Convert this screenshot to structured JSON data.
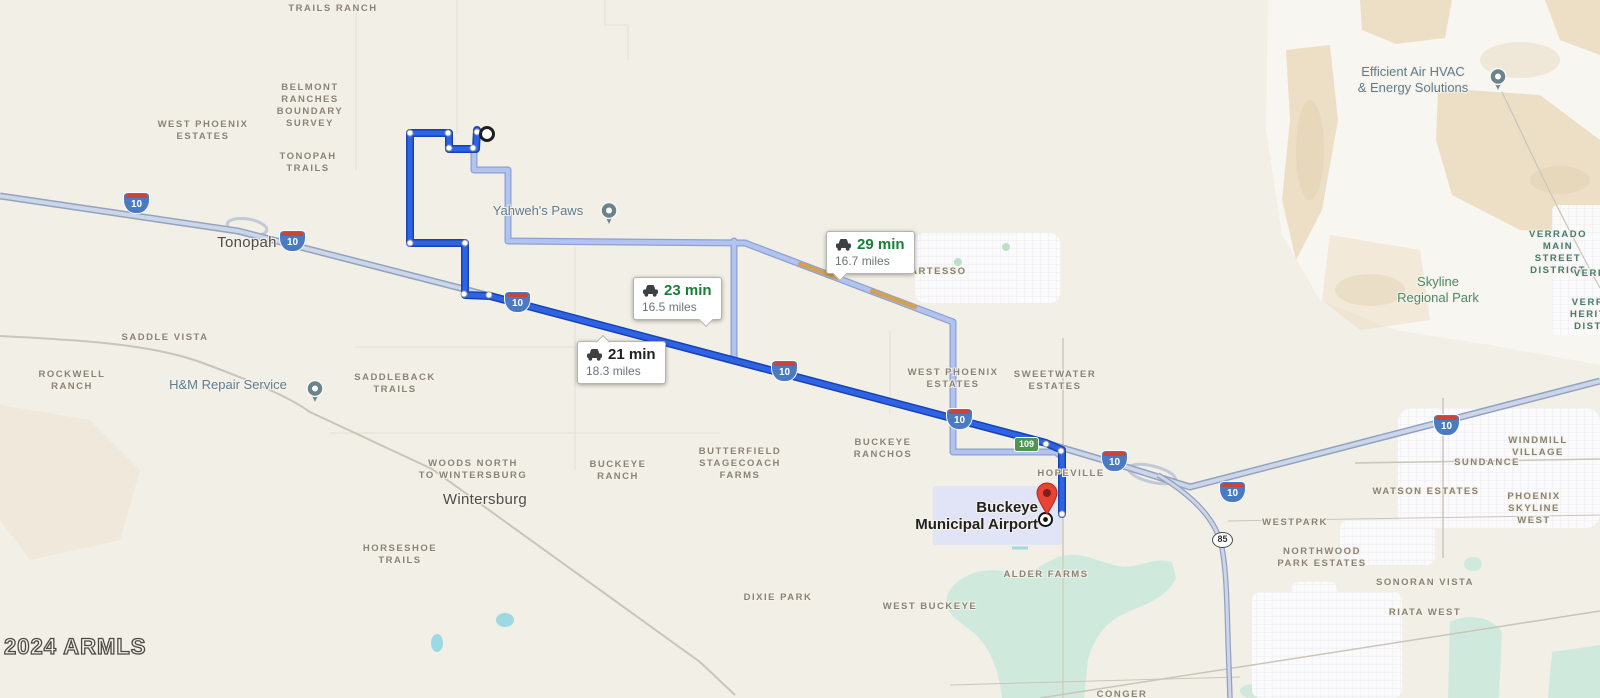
{
  "attribution": {
    "text": "2024 ARMLS"
  },
  "route_options": [
    {
      "duration": "21 min",
      "distance": "18.3 miles",
      "selected": true
    },
    {
      "duration": "23 min",
      "distance": "16.5 miles",
      "selected": false
    },
    {
      "duration": "29 min",
      "distance": "16.7 miles",
      "selected": false
    }
  ],
  "destination": {
    "name": "Buckeye\nMunicipal Airport"
  },
  "towns": [
    {
      "name": "Tonopah"
    },
    {
      "name": "Wintersburg"
    }
  ],
  "parks": [
    {
      "name": "Skyline\nRegional Park"
    }
  ],
  "businesses": [
    {
      "name": "Yahweh's Paws"
    },
    {
      "name": "Efficient Air HVAC\n& Energy Solutions"
    },
    {
      "name": "H&M Repair Service"
    }
  ],
  "areas": [
    {
      "name": "TRAILS RANCH"
    },
    {
      "name": "BELMONT\nRANCHES\nBOUNDARY\nSURVEY"
    },
    {
      "name": "WEST PHOENIX\nESTATES"
    },
    {
      "name": "TONOPAH\nTRAILS"
    },
    {
      "name": "SADDLE VISTA"
    },
    {
      "name": "ROCKWELL\nRANCH"
    },
    {
      "name": "SADDLEBACK\nTRAILS"
    },
    {
      "name": "WOODS NORTH\nTO WINTERSBURG"
    },
    {
      "name": "BUCKEYE\nRANCH"
    },
    {
      "name": "BUTTERFIELD\nSTAGECOACH\nFARMS"
    },
    {
      "name": "HORSESHOE\nTRAILS"
    },
    {
      "name": "DIXIE PARK"
    },
    {
      "name": "WEST BUCKEYE"
    },
    {
      "name": "ALDER FARMS"
    },
    {
      "name": "CONGER"
    },
    {
      "name": "TARTESSO"
    },
    {
      "name": "BUCKEYE\nRANCHOS"
    },
    {
      "name": "WEST PHOENIX\nESTATES"
    },
    {
      "name": "SWEETWATER\nESTATES"
    },
    {
      "name": "HOPEVILLE"
    },
    {
      "name": "WESTPARK"
    },
    {
      "name": "NORTHWOOD\nPARK ESTATES"
    },
    {
      "name": "WATSON ESTATES"
    },
    {
      "name": "SUNDANCE"
    },
    {
      "name": "WINDMILL\nVILLAGE"
    },
    {
      "name": "PHOENIX\nSKYLINE WEST"
    },
    {
      "name": "SONORAN VISTA"
    },
    {
      "name": "RIATA WEST"
    },
    {
      "name": "VERRADO MAIN\nSTREET DISTRICT"
    },
    {
      "name": "VERR"
    },
    {
      "name": "VERR\nHERIT\nDIST"
    }
  ],
  "shields": {
    "interstate": [
      {
        "label": "10"
      },
      {
        "label": "10"
      },
      {
        "label": "10"
      },
      {
        "label": "10"
      },
      {
        "label": "10"
      },
      {
        "label": "10"
      },
      {
        "label": "10"
      },
      {
        "label": "10"
      }
    ],
    "state_green": {
      "label": "109"
    },
    "state_oval": {
      "label": "85"
    }
  },
  "colors": {
    "selected_route": "#2e63e6",
    "alternate_route": "#b1c3ee",
    "traffic_slow": "#d2a156",
    "park_green": "#cfeadd",
    "water_blue": "#9ed8e2",
    "time_green": "#188038",
    "time_black": "#202124",
    "destination_pin": "#e94335"
  }
}
